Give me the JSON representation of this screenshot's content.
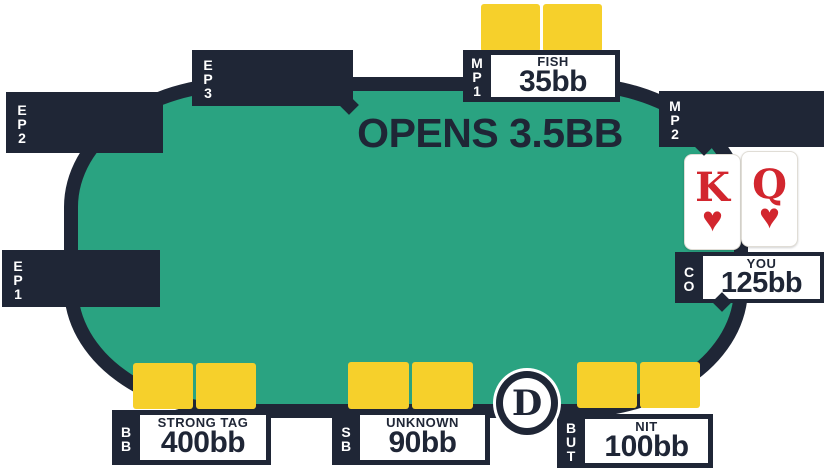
{
  "title": {
    "action_text": "OPENS 3.5BB"
  },
  "colors": {
    "felt": "#2aa381",
    "rail": "#1f2636",
    "card_back": "#f6d02b",
    "card_red": "#d2262e",
    "background": "#ffffff"
  },
  "seats": [
    {
      "position": "EP1",
      "status": "empty"
    },
    {
      "position": "EP2",
      "status": "empty"
    },
    {
      "position": "EP3",
      "status": "empty"
    },
    {
      "position": "MP1",
      "status": "open-raiser",
      "player_type": "FISH",
      "stack": "35bb",
      "card_backs": 2
    },
    {
      "position": "MP2",
      "status": "empty"
    },
    {
      "position": "CO",
      "status": "hero",
      "player_type": "YOU",
      "stack": "125bb"
    },
    {
      "position": "BUT",
      "status": "player",
      "player_type": "NIT",
      "stack": "100bb",
      "card_backs": 2
    },
    {
      "position": "SB",
      "status": "player",
      "player_type": "UNKNOWN",
      "stack": "90bb",
      "card_backs": 2
    },
    {
      "position": "BB",
      "status": "player",
      "player_type": "STRONG TAG",
      "stack": "400bb",
      "card_backs": 2
    }
  ],
  "hero": {
    "seat": "CO",
    "cards": [
      {
        "rank": "K",
        "suit": "♥"
      },
      {
        "rank": "Q",
        "suit": "♥"
      }
    ]
  },
  "dealer_button": {
    "label": "D"
  }
}
